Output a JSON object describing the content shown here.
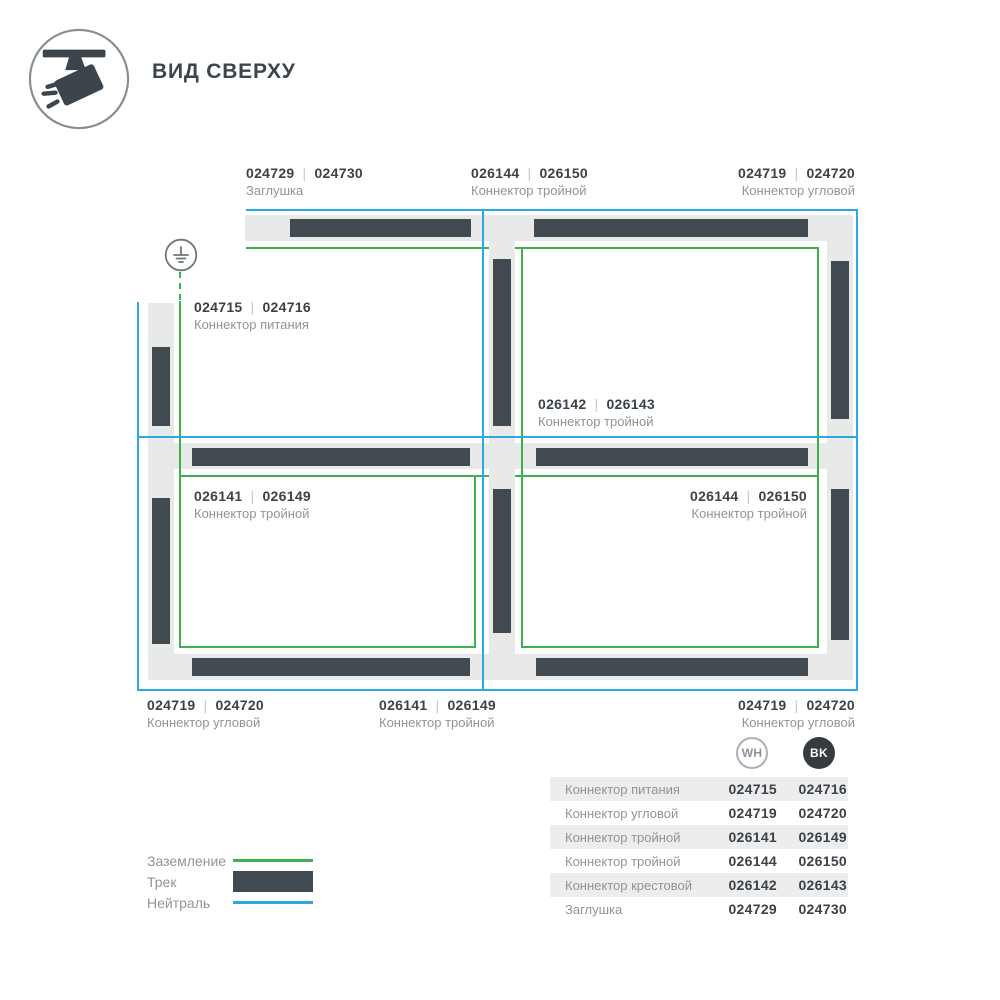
{
  "sep": "|",
  "header": {
    "title": "ВИД СВЕРХУ"
  },
  "diagram": {
    "labels": {
      "top_left": {
        "code_wh": "024729",
        "code_bk": "024730",
        "name": "Заглушка"
      },
      "top_center": {
        "code_wh": "026144",
        "code_bk": "026150",
        "name": "Коннектор тройной"
      },
      "top_right": {
        "code_wh": "024719",
        "code_bk": "024720",
        "name": "Коннектор угловой"
      },
      "power": {
        "code_wh": "024715",
        "code_bk": "024716",
        "name": "Коннектор питания"
      },
      "center": {
        "code_wh": "026142",
        "code_bk": "026143",
        "name": "Коннектор тройной"
      },
      "bottom_left_inner": {
        "code_wh": "026141",
        "code_bk": "026149",
        "name": "Коннектор тройной"
      },
      "bottom_right_inner": {
        "code_wh": "026144",
        "code_bk": "026150",
        "name": "Коннектор тройной"
      },
      "bottom_left": {
        "code_wh": "024719",
        "code_bk": "024720",
        "name": "Коннектор угловой"
      },
      "bottom_center": {
        "code_wh": "026141",
        "code_bk": "026149",
        "name": "Коннектор тройной"
      },
      "bottom_right": {
        "code_wh": "024719",
        "code_bk": "024720",
        "name": "Коннектор угловой"
      }
    }
  },
  "legend": {
    "items": [
      {
        "label": "Заземление",
        "swatch": "green-line"
      },
      {
        "label": "Трек",
        "swatch": "track-bar"
      },
      {
        "label": "Нейтраль",
        "swatch": "blue-line"
      }
    ]
  },
  "table": {
    "columns": [
      {
        "id": "wh",
        "badge": "WH"
      },
      {
        "id": "bk",
        "badge": "BK"
      }
    ],
    "rows": [
      {
        "name": "Коннектор питания",
        "wh": "024715",
        "bk": "024716"
      },
      {
        "name": "Коннектор угловой",
        "wh": "024719",
        "bk": "024720"
      },
      {
        "name": "Коннектор тройной",
        "wh": "026141",
        "bk": "026149"
      },
      {
        "name": "Коннектор тройной",
        "wh": "026144",
        "bk": "026150"
      },
      {
        "name": "Коннектор крестовой",
        "wh": "026142",
        "bk": "026143"
      },
      {
        "name": "Заглушка",
        "wh": "024729",
        "bk": "024730"
      }
    ]
  },
  "colors": {
    "neutral_blue": "#2ca9e1",
    "ground_green": "#3fb04d",
    "track_dark": "#424a51",
    "track_light": "#e8e9e9",
    "table_row_gray": "#ededee"
  }
}
